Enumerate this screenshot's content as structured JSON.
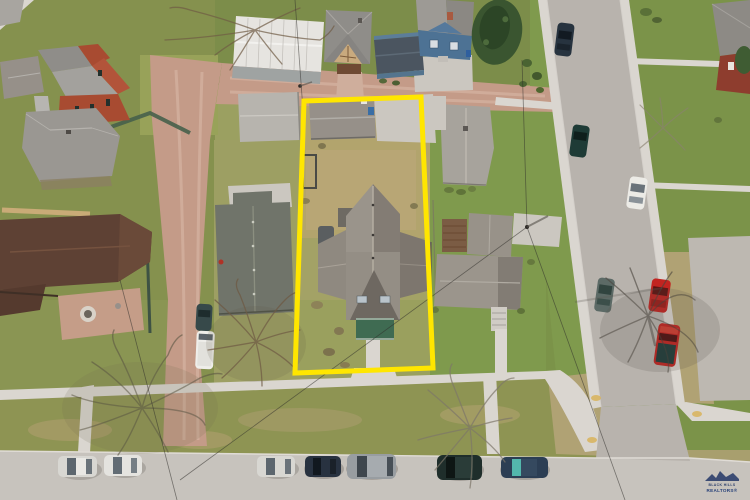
{
  "watermark": {
    "line1": "BLACK HILLS",
    "line2": "REALTORS®"
  },
  "outline": {
    "label": "subject property boundary",
    "color": "#ffe600"
  },
  "colors": {
    "base-olive": "#a89f6e",
    "grass-left": "#85914e",
    "grass-north": "#7c8d4a",
    "grass-east": "#7f9a4d",
    "grass-right": "#7b9349",
    "grass-olive": "#9ba061",
    "grass-dead": "#b2a46d",
    "grass-boulevard": "#8e9453",
    "grass-tan": "#b0a274",
    "dirt-alley": "#c49b88",
    "dirt-track": "#d6b4a2",
    "street": "#b8b3ad",
    "street-bottom": "#c7c3bd",
    "sidewalk": "#dad6d0",
    "concrete-pad": "#cbc7c0",
    "paved-lot": "#bdb8b1",
    "roof-gray": "#969089",
    "roof-gray-dark": "#837c74",
    "roof-light": "#b7b4ae",
    "roof-white": "#e6e4e0",
    "roof-brown": "#5e4134",
    "roof-westneighbor": "#70746a",
    "roof-neighbor": "#a7a39c",
    "red-house": "#a84b31",
    "brick-house": "#8e3d2e",
    "blue-house": "#4d7294",
    "blue-shed": "#4b5560",
    "porch-green": "#3f6b52",
    "pine-green": "#3a5530",
    "tree-branch": "#6e5a44",
    "shadow": "#55504a",
    "outline-yellow": "#ffe600",
    "car-red": "#c22420",
    "car-navy": "#283240",
    "car-teal-dark": "#1f2e2b",
    "car-silver": "#d8d7d2",
    "car-white": "#ecebe6",
    "car-gray": "#989da1",
    "van-white": "#efeeea",
    "logo-navy": "#2c3f6b"
  }
}
